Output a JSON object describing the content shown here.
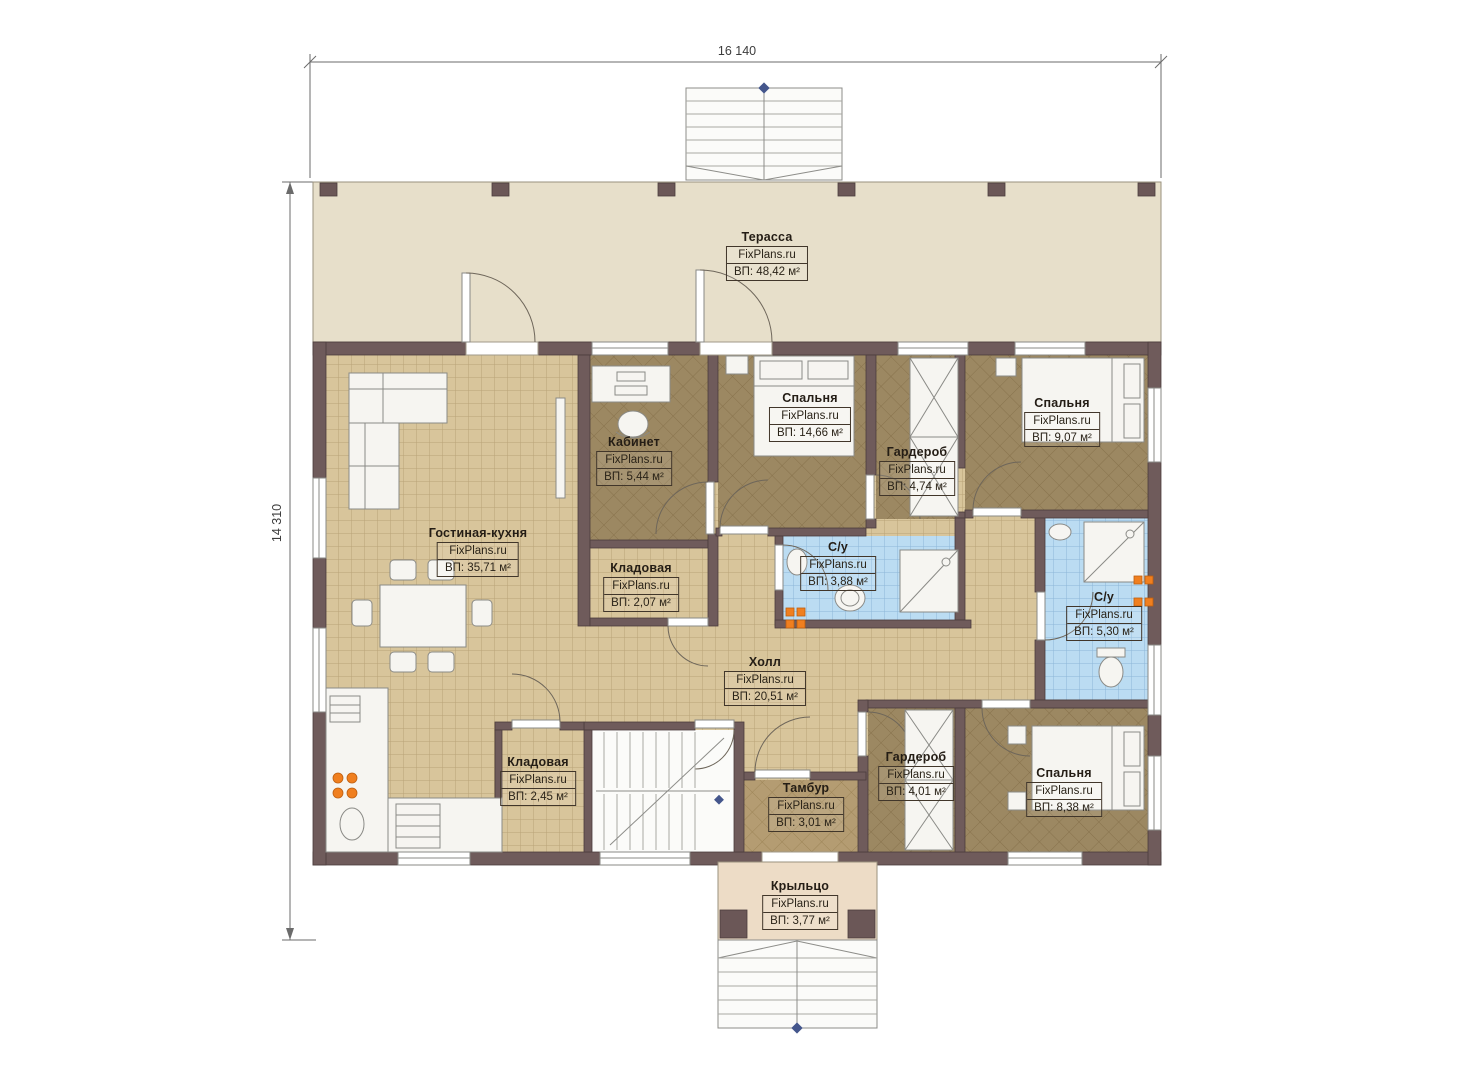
{
  "plan": {
    "brand": "FixPlans.ru",
    "dimensions": {
      "width_label": "16 140",
      "height_label": "14 310"
    },
    "rooms": [
      {
        "name": "Терасса",
        "area": "ВП: 48,42 м²"
      },
      {
        "name": "Кабинет",
        "area": "ВП: 5,44 м²"
      },
      {
        "name": "Спальня",
        "area": "ВП: 14,66 м²"
      },
      {
        "name": "Гардероб",
        "area": "ВП: 4,74 м²"
      },
      {
        "name": "Спальня",
        "area": "ВП: 9,07 м²"
      },
      {
        "name": "Гостиная-кухня",
        "area": "ВП: 35,71 м²"
      },
      {
        "name": "Кладовая",
        "area": "ВП: 2,07 м²"
      },
      {
        "name": "С/у",
        "area": "ВП: 3,88 м²"
      },
      {
        "name": "С/у",
        "area": "ВП: 5,30 м²"
      },
      {
        "name": "Холл",
        "area": "ВП: 20,51 м²"
      },
      {
        "name": "Кладовая",
        "area": "ВП: 2,45 м²"
      },
      {
        "name": "Тамбур",
        "area": "ВП: 3,01 м²"
      },
      {
        "name": "Гардероб",
        "area": "ВП: 4,01 м²"
      },
      {
        "name": "Спальня",
        "area": "ВП: 8,38 м²"
      },
      {
        "name": "Крыльцо",
        "area": "ВП: 3,77 м²"
      }
    ],
    "colors": {
      "wall": "#6f5b5b",
      "floor_tan": "#d8c59b",
      "floor_dark": "#9c8862",
      "tile_blue": "#bbdcf2",
      "terrace": "#e7dfca",
      "porch": "#eddcc6",
      "accent_orange": "#f07f1f"
    }
  }
}
